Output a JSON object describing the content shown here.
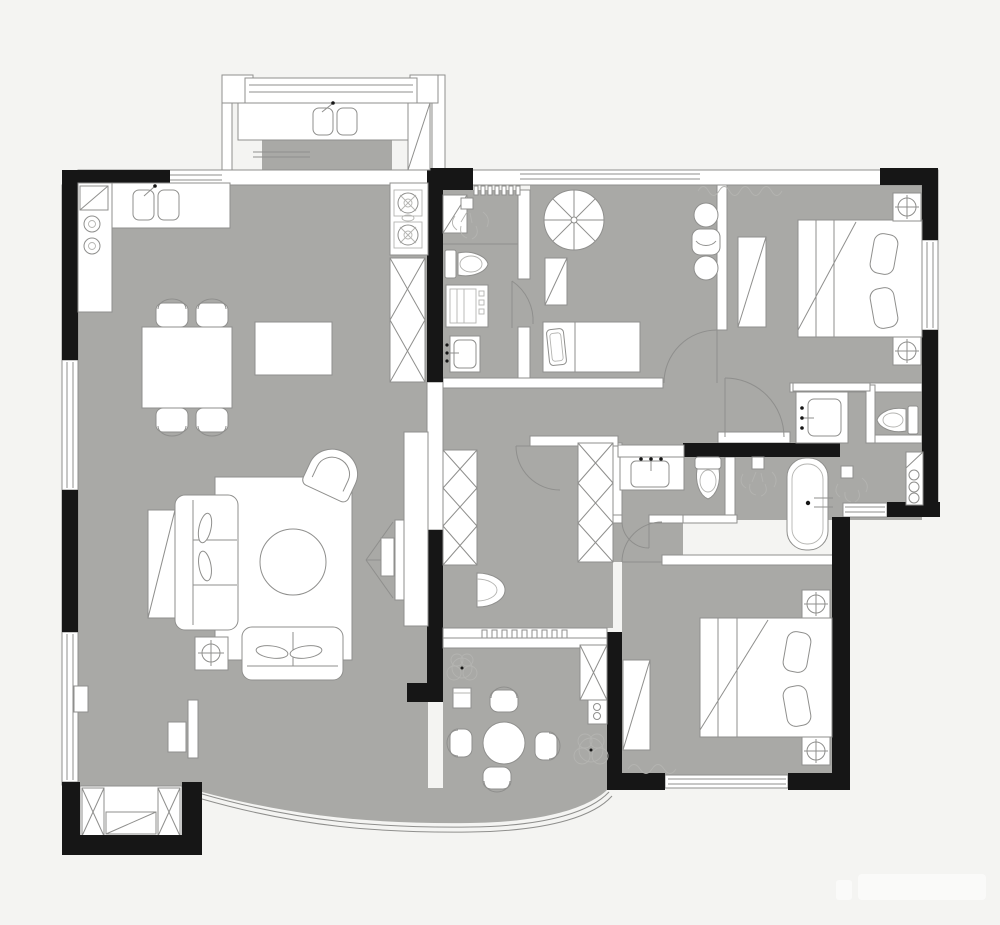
{
  "meta": {
    "kind": "residential-floor-plan",
    "view": "top-down",
    "text_labels_visible": false
  },
  "colors": {
    "background": "#f4f4f2",
    "floor": "#a9a9a6",
    "wall_fill": "#ffffff",
    "wall_dark": "#161616",
    "line": "#8f8f8d",
    "line_light": "#b4b4b1",
    "watermark": "#fbfbfa"
  },
  "rooms": [
    {
      "name": "utility-balcony",
      "furniture": [
        "counter",
        "double-sink",
        "tall-cabinet",
        "window-band"
      ]
    },
    {
      "name": "kitchen",
      "furniture": [
        "l-counter",
        "double-sink",
        "corner-sink",
        "two-burner-cooktop",
        "gas-cooktop",
        "pantry-x-cabinet"
      ]
    },
    {
      "name": "dining-area",
      "furniture": [
        "dining-table",
        "chair",
        "chair",
        "chair",
        "chair",
        "island-sideboard"
      ]
    },
    {
      "name": "living-room",
      "furniture": [
        "rug",
        "three-seat-sofa",
        "side-console",
        "lounge-armchair",
        "round-coffee-table",
        "loveseat",
        "floor-lamp",
        "tv-panel",
        "media-console"
      ]
    },
    {
      "name": "bay-window-seat",
      "furniture": [
        "window-bench",
        "x-end-cabinets"
      ]
    },
    {
      "name": "bathroom-1",
      "furniture": [
        "shower-head",
        "corner-shelf",
        "toilet",
        "washing-machine",
        "basin"
      ]
    },
    {
      "name": "kids-bedroom",
      "furniture": [
        "parasol-decor",
        "single-bed",
        "side-table",
        "barrel-table",
        "lounge-chair",
        "barrel-table"
      ]
    },
    {
      "name": "hallway",
      "furniture": [
        "storage-closet-west",
        "storage-closet-east",
        "half-round-console"
      ]
    },
    {
      "name": "master-bedroom",
      "furniture": [
        "double-bed",
        "pillows",
        "nightstand-lamp",
        "nightstand-lamp",
        "wardrobe",
        "curtain"
      ]
    },
    {
      "name": "master-bathroom",
      "furniture": [
        "vanity-basin",
        "toilet",
        "bathtub",
        "shower-head",
        "shower-head",
        "shelf-cabinet"
      ]
    },
    {
      "name": "bathroom-2",
      "furniture": [
        "vanity-basin",
        "toilet"
      ]
    },
    {
      "name": "bedroom-3",
      "furniture": [
        "double-bed",
        "pillows",
        "nightstand-lamp",
        "nightstand-lamp",
        "wardrobe",
        "dresser",
        "curtain",
        "window-band"
      ]
    },
    {
      "name": "balcony",
      "furniture": [
        "round-table",
        "patio-chair",
        "patio-chair",
        "patio-chair",
        "patio-chair",
        "plant",
        "plant",
        "x-cabinet",
        "appliance"
      ]
    }
  ],
  "watermark": {
    "present": true,
    "legible": false
  }
}
